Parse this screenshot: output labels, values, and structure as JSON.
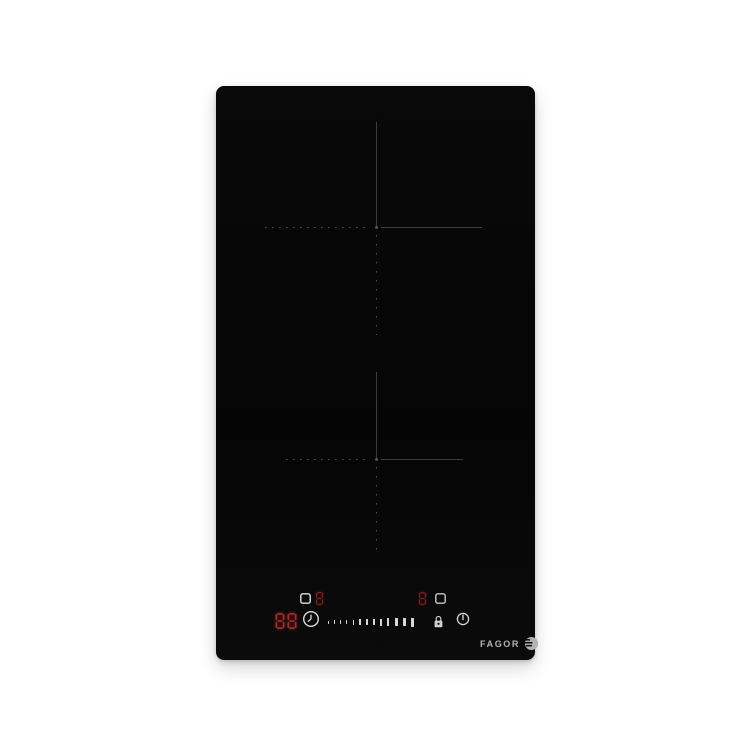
{
  "product": {
    "name": "domino-induction-hob",
    "brand": "FAGOR"
  },
  "colors": {
    "background": "#ffffff",
    "glass": "#070707",
    "zone_guide_line": "#3d3d3d",
    "zone_guide_dot": "#4f4f4f",
    "power_digit_dim_red": "#7a1d1d",
    "timer_digit_red": "#b12a2a",
    "icon_white": "#e2e2e2",
    "logo_gray": "#b3b3b3"
  },
  "zones": [
    {
      "id": "rear-zone",
      "marking": "cross-with-dotted-arms"
    },
    {
      "id": "front-zone",
      "marking": "cross-with-dotted-arms"
    }
  ],
  "display": {
    "rear_zone_power": "8",
    "front_zone_power": "8",
    "timer_tens": "8",
    "timer_units": "8",
    "timer_value": "88"
  },
  "slider": {
    "levels": 13
  },
  "icons": {
    "rear_zone_select": "pot-icon",
    "front_zone_select": "pot-icon",
    "timer": "clock-icon",
    "child_lock": "padlock-icon",
    "power": "power-icon"
  },
  "logo": {
    "text": "FAGOR",
    "emblem": "fagor-circle-emblem"
  }
}
